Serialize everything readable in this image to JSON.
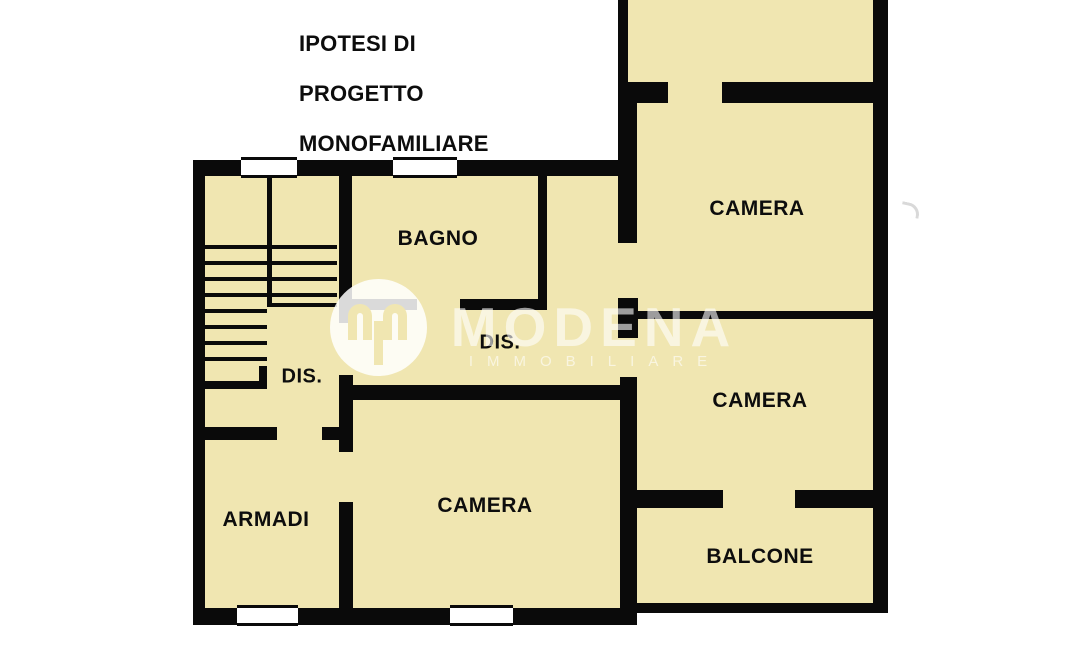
{
  "title": {
    "line1": "IPOTESI DI",
    "line2": "PROGETTO",
    "line3": "MONOFAMILIARE"
  },
  "rooms": {
    "bagno": {
      "label": "BAGNO"
    },
    "dis_corridor": {
      "label": "DIS."
    },
    "dis_landing": {
      "label": "DIS."
    },
    "camera_top": {
      "label": "CAMERA"
    },
    "camera_mid": {
      "label": "CAMERA"
    },
    "camera_bottom": {
      "label": "CAMERA"
    },
    "armadi": {
      "label": "ARMADI"
    },
    "balcone": {
      "label": "BALCONE"
    }
  },
  "watermark": {
    "brand": "MODENA",
    "subtitle": "IMMOBILIARE"
  },
  "colors": {
    "floor": "#F0E6B1",
    "wall": "#0A0A0A",
    "background": "#FFFFFF",
    "label_text": "#0D0D0D"
  }
}
